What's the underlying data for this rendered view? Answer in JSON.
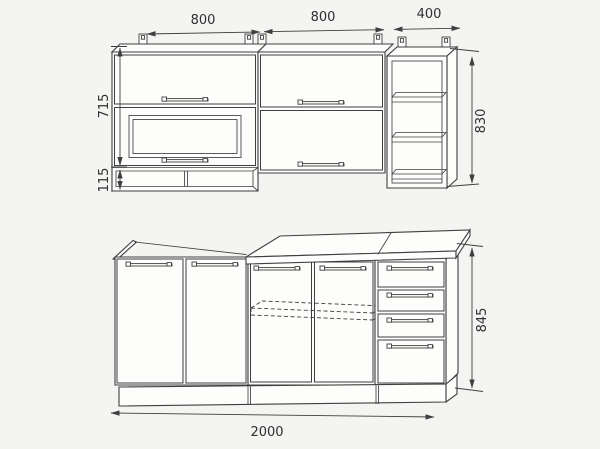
{
  "theme": {
    "bg": "#f4f4f2",
    "line": "#3f3f3f",
    "face": "#fdfdfc",
    "dim_text": "#2f2f2f"
  },
  "dimensions": {
    "wall_left_width": "800",
    "wall_middle_width": "800",
    "wall_right_width": "400",
    "wall_doors_height": "715",
    "wall_niche_height": "115",
    "wall_total_height": "830",
    "base_total_width": "2000",
    "base_height": "845"
  }
}
